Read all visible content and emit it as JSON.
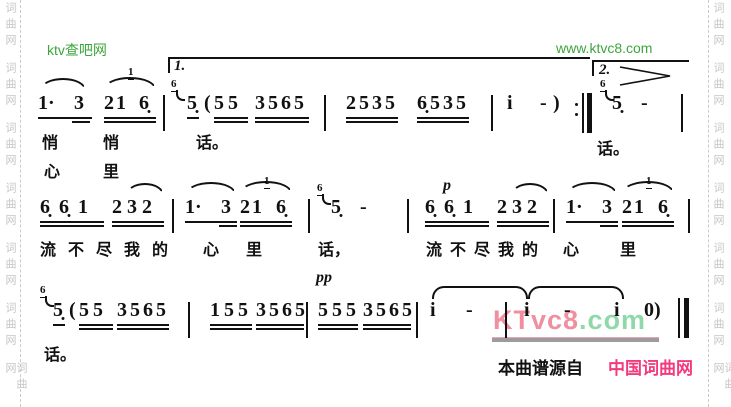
{
  "borders": {
    "side_text": "词曲网"
  },
  "watermarks": {
    "top_left": "ktv查吧网",
    "top_right": "www.ktvc8.com",
    "mid_pink": "KTvc8",
    "mid_green": ".com"
  },
  "colors": {
    "watermark_green": "#3da53d",
    "watermark_pink": "#ef8f9f",
    "watermark_light_green": "#8fd8a8",
    "brand_pink": "#f23a7c"
  },
  "credit": {
    "prefix": "本曲谱源自",
    "brand": "中国词曲网"
  },
  "voltas": {
    "first": "1.",
    "second": "2."
  },
  "dynamics": {
    "p": "p",
    "pp": "pp"
  },
  "score": {
    "line1": {
      "n1": "1·",
      "n2": "3",
      "n3": "21",
      "g1": "1",
      "n4": "6̣",
      "g2": "6",
      "n5": "5̣",
      "paren_open": "(",
      "n6": "55",
      "n7": "3565",
      "n8": "2535",
      "n9": "6̣535",
      "n10": "i",
      "n11": "-",
      "paren_close": ")",
      "g3": "6",
      "n12": "5̣",
      "n13": "-"
    },
    "line2": {
      "n1": "6̣6̣1",
      "n2": "232",
      "n3": "1·",
      "n4": "3",
      "n5": "21",
      "g1": "1",
      "n6": "6̣",
      "g2": "6",
      "n7": "5̣",
      "n8": "-",
      "n9": "6̣6̣1",
      "n10": "232",
      "n11": "1·",
      "n12": "3",
      "n13": "21",
      "g3": "1",
      "n14": "6̣"
    },
    "line3": {
      "g1": "6",
      "n1": "5̣",
      "paren_open": "(",
      "n2": "55",
      "n3": "3565",
      "n4": "155",
      "n5": "3565",
      "n6": "555",
      "n7": "3565",
      "n8": "i",
      "n9": "-",
      "n10": "i",
      "n11": "-",
      "n12": "i",
      "n13": "0)"
    }
  },
  "lyrics": {
    "r1a": [
      "悄",
      "悄",
      "话。"
    ],
    "r1b": [
      "心",
      "里"
    ],
    "r1c": "话。",
    "r2": [
      "流",
      "不",
      "尽",
      "我",
      "的",
      "心",
      "里",
      "话，",
      "流",
      "不",
      "尽",
      "我",
      "的",
      "心",
      "里"
    ],
    "r3": "话。"
  }
}
